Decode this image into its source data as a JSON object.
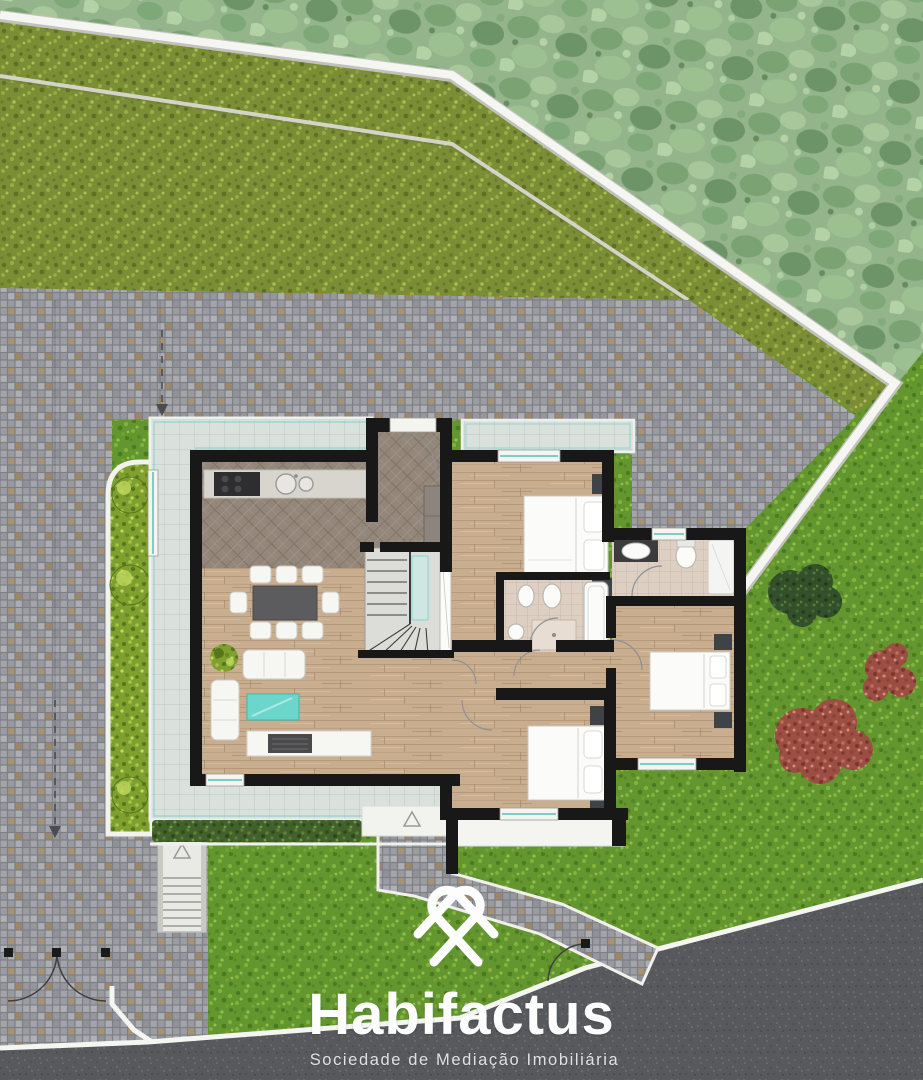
{
  "logo": {
    "brand": "Habifactus",
    "tagline": "Sociedade de Mediação Imobiliária",
    "icon": "heart-knot-icon",
    "text_color": "#fdfdfd"
  },
  "palette": {
    "canopy_green": "#94b48c",
    "hillside_green": "#7b8d35",
    "lawn_green": "#649630",
    "hedge_green": "#42612b",
    "planter_green": "#7fa02e",
    "shrub_red": "#9b4e42",
    "dark_bush_green": "#33502a",
    "cobblestone_gray": "#9b9ca2",
    "asphalt_gray": "#57595c",
    "boundary_white": "#f4f4f0",
    "wall_black": "#181818",
    "wood_floor": "#c9ad8f",
    "hall_floor": "#93867a",
    "terrace_tile": "#dae0dc",
    "bathroom_tile": "#ddcfc2",
    "counter_stone": "#d8d4ce",
    "accent_teal": "#6cd6cc",
    "glass_teal": "#7fd2c7"
  }
}
